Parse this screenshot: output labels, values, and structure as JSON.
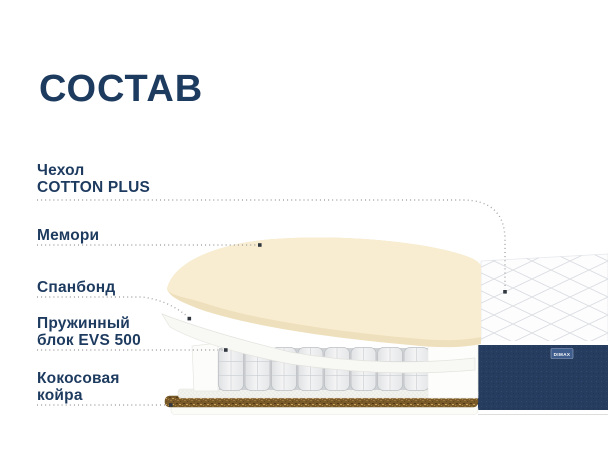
{
  "title": "СОСТАВ",
  "labels": [
    {
      "line1": "Чехол",
      "line2": "COTTON PLUS"
    },
    {
      "line1": "Мемори",
      "line2": ""
    },
    {
      "line1": "Спанбонд",
      "line2": ""
    },
    {
      "line1": "Пружинный",
      "line2": "блок EVS 500"
    },
    {
      "line1": "Кокосовая",
      "line2": "койра"
    }
  ],
  "brand_logo": "DIMAX",
  "colors": {
    "heading": "#1d3a5f",
    "label_text": "#1d3a5f",
    "leader_dots": "#a6a6a6",
    "leader_endpoint": "#30373f",
    "memory_foam": "#f9edd1",
    "memory_foam_edge": "#eee0bc",
    "spunbond": "#f8f8f5",
    "spring_pocket": "#ebecee",
    "coconut_coir": "#7b5a29",
    "side_band": "#273d60",
    "quilt_line": "#d9dce1"
  }
}
